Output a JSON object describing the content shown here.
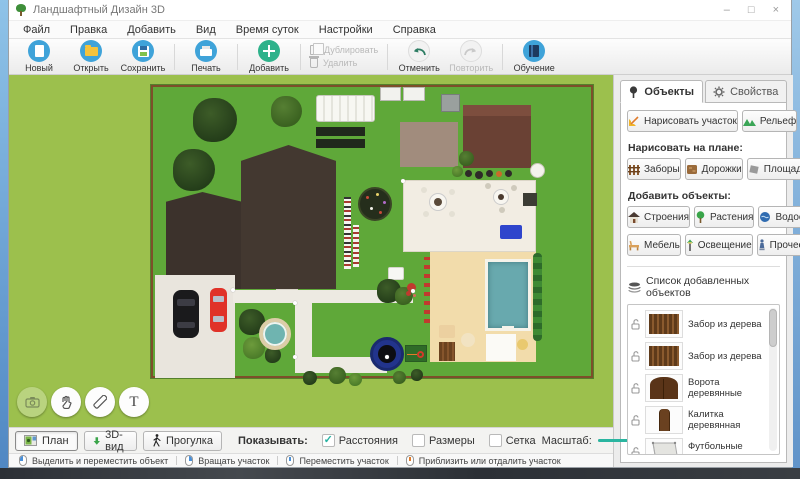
{
  "window": {
    "title": "Ландшафтный Дизайн 3D",
    "controls": {
      "minimize": "–",
      "maximize": "□",
      "close": "×"
    }
  },
  "menu": {
    "items": [
      "Файл",
      "Правка",
      "Добавить",
      "Вид",
      "Время суток",
      "Настройки",
      "Справка"
    ]
  },
  "toolbar": {
    "buttons": [
      {
        "label": "Новый",
        "enabled": true
      },
      {
        "label": "Открыть",
        "enabled": true
      },
      {
        "label": "Сохранить",
        "enabled": true
      },
      {
        "label": "Печать",
        "enabled": true
      },
      {
        "label": "Добавить",
        "enabled": true
      },
      {
        "label": "Дублировать",
        "enabled": false
      },
      {
        "label": "Удалить",
        "enabled": false
      },
      {
        "label": "Отменить",
        "enabled": true
      },
      {
        "label": "Повторить",
        "enabled": false
      },
      {
        "label": "Обучение",
        "enabled": true
      }
    ]
  },
  "canvas": {
    "text_tool_glyph": "T"
  },
  "panel": {
    "tabs": [
      {
        "label": "Объекты",
        "active": true
      },
      {
        "label": "Свойства",
        "active": false
      }
    ],
    "draw_plot": "Нарисовать участок",
    "relief": "Рельеф",
    "draw_on_plan_label": "Нарисовать на плане:",
    "draw_buttons": [
      "Заборы",
      "Дорожки",
      "Площадки"
    ],
    "add_objects_label": "Добавить объекты:",
    "add_buttons": [
      "Строения",
      "Растения",
      "Водоемы",
      "Мебель",
      "Освещение",
      "Прочее"
    ],
    "list_label": "Список добавленных объектов",
    "list_items": [
      {
        "label": "Забор из дерева"
      },
      {
        "label": "Забор из дерева"
      },
      {
        "label": "Ворота деревянные"
      },
      {
        "label": "Калитка деревянная"
      },
      {
        "label": "Футбольные ворота"
      }
    ]
  },
  "bottom_bar": {
    "view_buttons": [
      {
        "label": "План",
        "active": true
      },
      {
        "label": "3D-вид",
        "active": false
      },
      {
        "label": "Прогулка",
        "active": false
      }
    ],
    "show_label": "Показывать:",
    "check_glyph": "✓",
    "checkboxes": [
      {
        "label": "Расстояния",
        "checked": true
      },
      {
        "label": "Размеры",
        "checked": false
      },
      {
        "label": "Сетка",
        "checked": false
      }
    ],
    "scale_label": "Масштаб:",
    "scale_value": "77%"
  },
  "status_bar": {
    "hints": [
      "Выделить и переместить объект",
      "Вращать участок",
      "Переместить участок",
      "Приблизить или отдалить участок"
    ]
  },
  "colors": {
    "accent_teal": "#2ab5a0",
    "toolbar_blue": "#3fa3d9",
    "add_green": "#2eb28b",
    "workspace_green": "#9cc04d",
    "plot_green": "#5fa839"
  }
}
